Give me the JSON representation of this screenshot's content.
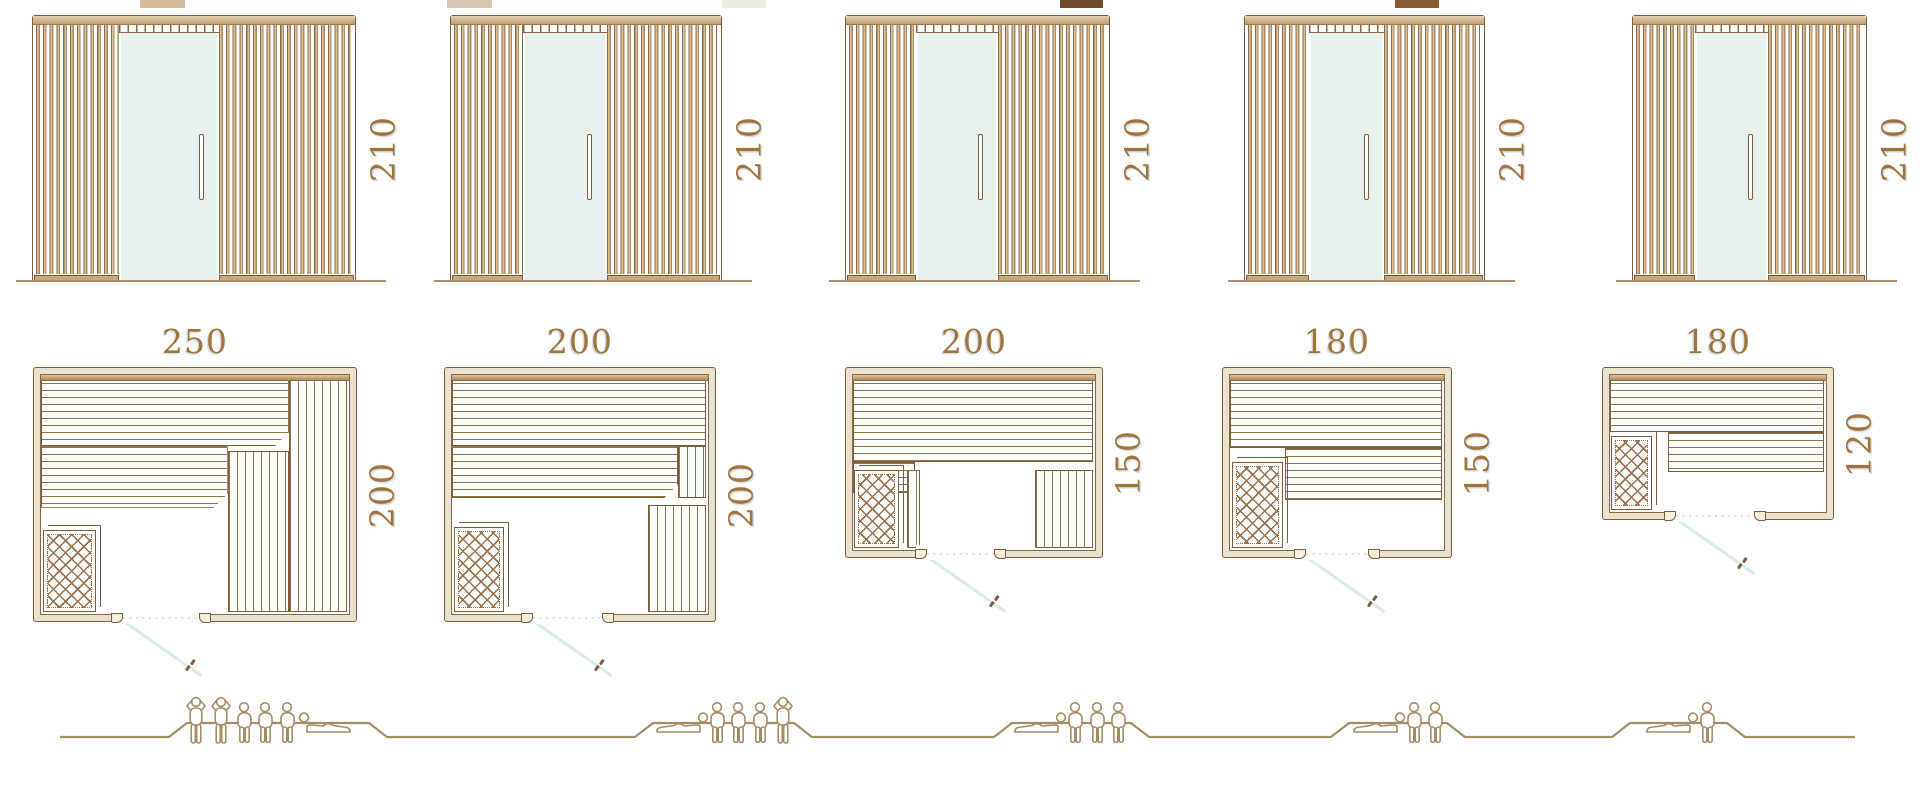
{
  "diagram": {
    "kind": "sauna-size-comparison",
    "columns": 5,
    "views_per_model": [
      "front-elevation",
      "floor-plan",
      "capacity-figures"
    ]
  },
  "colors": {
    "line": "#7e5c3a",
    "wood_light": "#d9c09d",
    "wood_mid": "#b08a58",
    "wall_fill": "#ebe2cd",
    "glass": "#e7f2ef",
    "swing": "#d9ece6",
    "dot": "#cfe5df",
    "people": "#a58c64",
    "dimension": "#a1743c",
    "ground": "#b18e6b",
    "lattice": "#9b7048"
  },
  "models": [
    {
      "name": "sauna-250x200",
      "width": "250",
      "depth": "200",
      "height": "210",
      "capacity": 6,
      "people": {
        "standing": 2,
        "sitting": 3,
        "reclining": 1
      },
      "swatch": "#d2bc98"
    },
    {
      "name": "sauna-200x200",
      "width": "200",
      "depth": "200",
      "height": "210",
      "capacity": 5,
      "people": {
        "standing": 1,
        "sitting": 3,
        "reclining": 1
      },
      "swatch": "#d5c9b3"
    },
    {
      "name": "sauna-200x150",
      "width": "200",
      "depth": "150",
      "height": "210",
      "capacity": 4,
      "people": {
        "standing": 0,
        "sitting": 3,
        "reclining": 1
      },
      "swatch": "#efeade"
    },
    {
      "name": "sauna-180x150",
      "width": "180",
      "depth": "150",
      "height": "210",
      "capacity": 3,
      "people": {
        "standing": 0,
        "sitting": 2,
        "reclining": 1
      },
      "swatch": "#6f4b2d"
    },
    {
      "name": "sauna-180x120",
      "width": "180",
      "depth": "120",
      "height": "210",
      "capacity": 2,
      "people": {
        "standing": 0,
        "sitting": 1,
        "reclining": 1
      },
      "swatch": "#8a5c36"
    }
  ]
}
